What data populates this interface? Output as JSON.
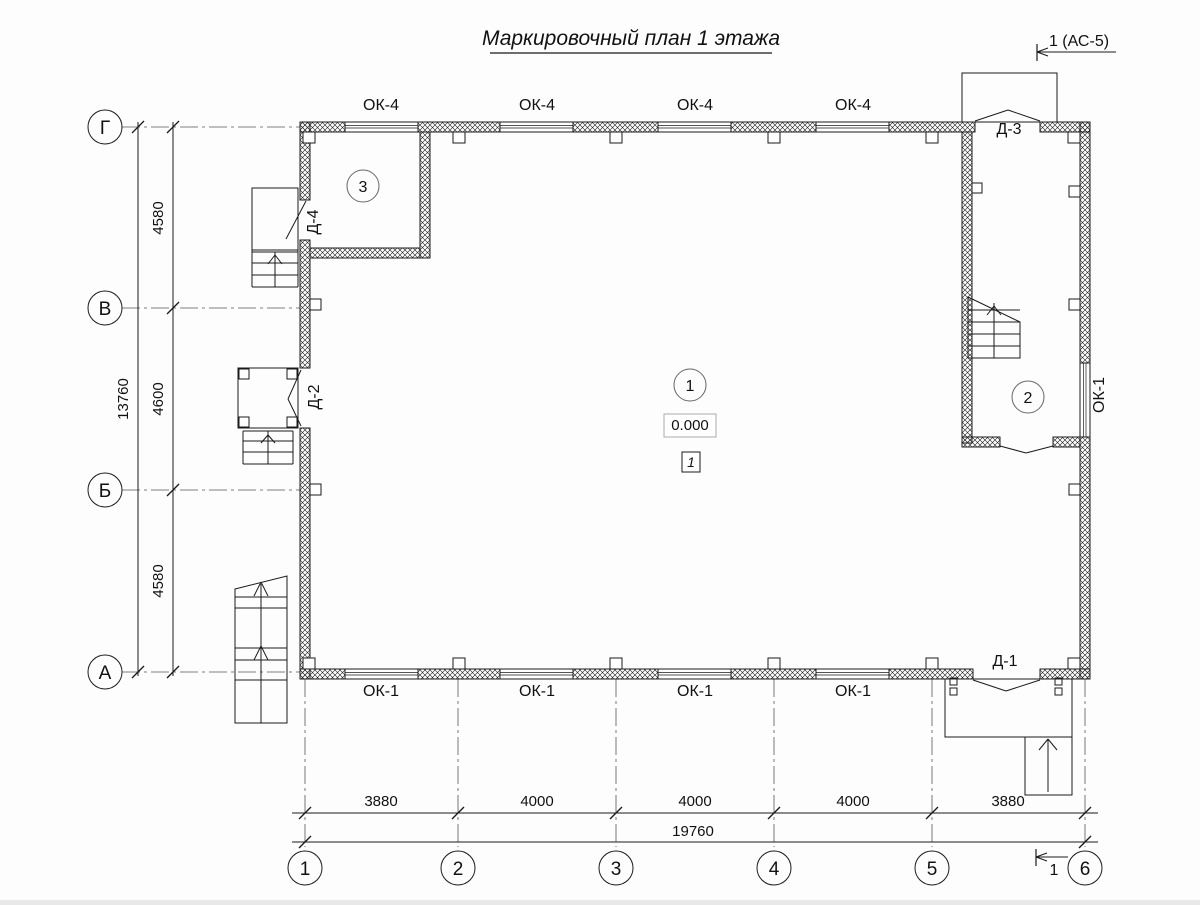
{
  "title": "Маркировочный план 1 этажа",
  "section_marks": {
    "top": "1 (АС-5)",
    "bottom": "1"
  },
  "axis_labels": {
    "rows": [
      "Г",
      "В",
      "Б",
      "А"
    ],
    "cols": [
      "1",
      "2",
      "3",
      "4",
      "5",
      "6"
    ]
  },
  "dimensions": {
    "left_segments": [
      "4580",
      "4600",
      "4580"
    ],
    "left_total": "13760",
    "bottom_segments": [
      "3880",
      "4000",
      "4000",
      "4000",
      "3880"
    ],
    "bottom_total": "19760"
  },
  "windows": {
    "top": [
      "ОК-4",
      "ОК-4",
      "ОК-4",
      "ОК-4"
    ],
    "bottom": [
      "ОК-1",
      "ОК-1",
      "ОК-1",
      "ОК-1"
    ],
    "right": "ОК-1"
  },
  "doors": {
    "d4": "Д-4",
    "d2": "Д-2",
    "d3": "Д-3",
    "d1": "Д-1"
  },
  "rooms": {
    "r1": "1",
    "r2": "2",
    "r3": "3"
  },
  "elevation": "0.000",
  "furniture_mark": "1",
  "colors": {
    "line": "#1a1a1a",
    "grid": "#555555",
    "light_box": "#aaaaaa"
  }
}
